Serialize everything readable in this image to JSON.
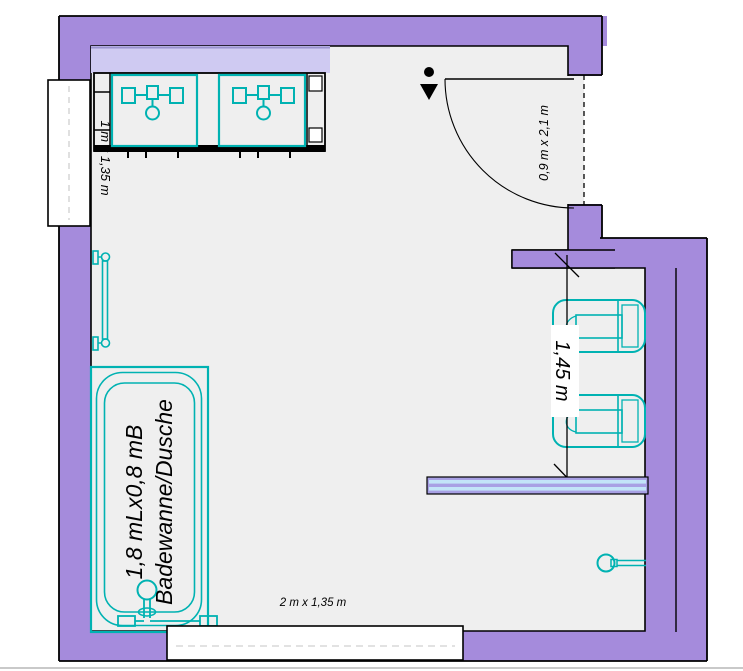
{
  "document": {
    "type": "bathroom-floor-plan",
    "application": "cad-room-planner"
  },
  "labels": {
    "window_left": "1 m x 1,35 m",
    "door": "0,9 m x 2,1 m",
    "wc_niche_depth": "1,45 m",
    "bathtub_size": "1,8 mLx0,8 mB",
    "bathtub_name": "Badewanne/Dusche",
    "window_bottom": "2 m x 1,35 m"
  },
  "fixtures": [
    "washbasin-left",
    "washbasin-right",
    "mirror-shelf",
    "window-left",
    "towel-rail",
    "bathtub-shower",
    "window-bottom",
    "door-swing",
    "wc-partition-stub",
    "wc-1",
    "wc-2",
    "glass-partition",
    "shower-head"
  ],
  "colors": {
    "wall": "#A58BDC",
    "floor": "#EFEFEF",
    "fixture_teal": "#00B2B2",
    "mirror_band": "#CFCAF2",
    "glass_partition_fill": "#A8A0E4",
    "glass_partition_stripe": "#C2E4F8",
    "outline": "#000000",
    "window_fill": "#FFFFFF"
  }
}
